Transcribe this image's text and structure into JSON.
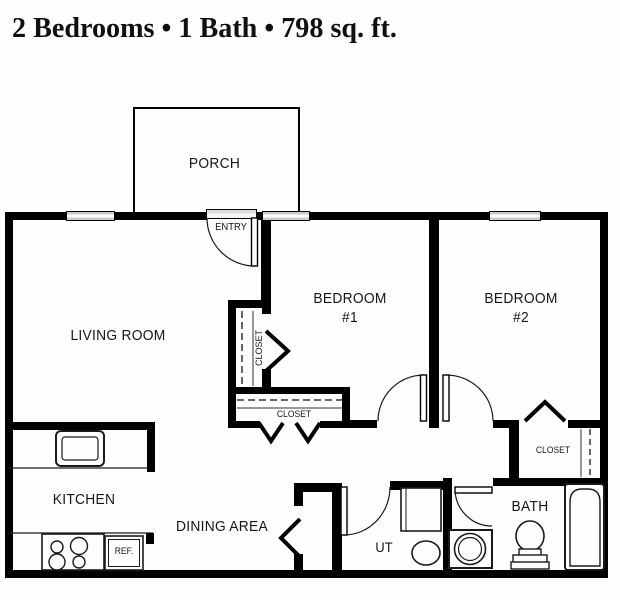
{
  "title": {
    "text": "2 Bedrooms  •  1 Bath  •  798 sq. ft."
  },
  "labels": {
    "porch": "PORCH",
    "entry": "ENTRY",
    "living_room": "LIVING ROOM",
    "bedroom1_line1": "BEDROOM",
    "bedroom1_line2": "#1",
    "bedroom2_line1": "BEDROOM",
    "bedroom2_line2": "#2",
    "closet_bedroom1": "CLOSET",
    "closet_hall": "CLOSET",
    "closet_bedroom2": "CLOSET",
    "kitchen": "KITCHEN",
    "dining_area": "DINING AREA",
    "utility": "UT",
    "bath": "BATH",
    "refrigerator": "REF."
  },
  "colors": {
    "wall": "#000000",
    "text": "#161616",
    "window_fill": "#c9c9c9",
    "background": "#fefefe"
  }
}
